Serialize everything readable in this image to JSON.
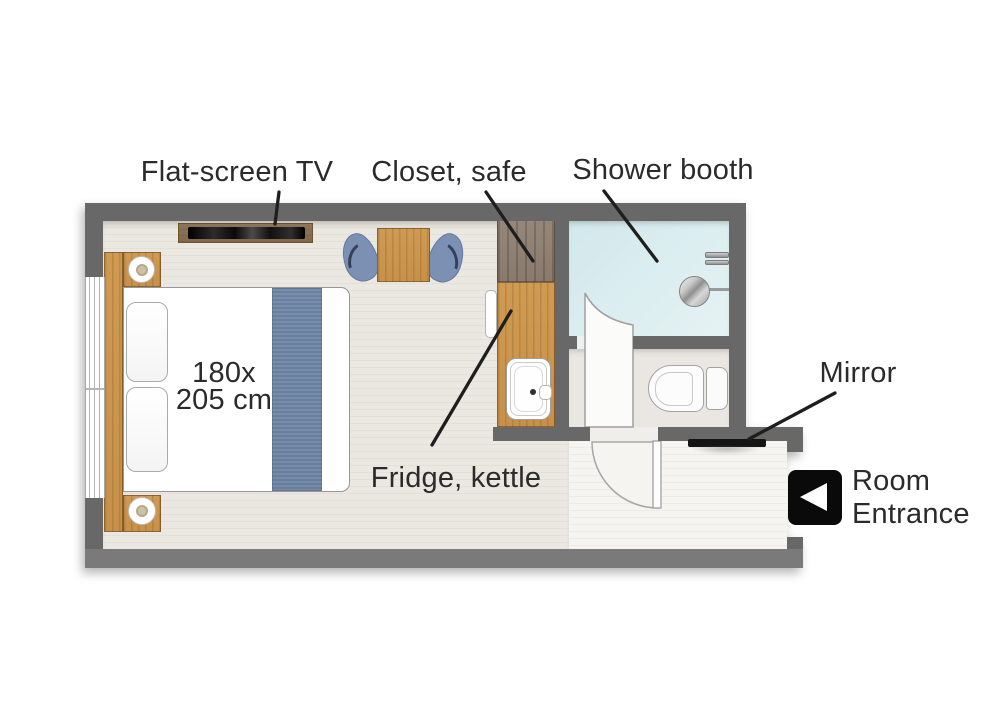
{
  "labels": {
    "flat_screen_tv": "Flat-screen TV",
    "closet_safe": "Closet, safe",
    "shower_booth": "Shower booth",
    "fridge_kettle": "Fridge, kettle",
    "mirror": "Mirror",
    "room_entrance": "Room\nEntrance",
    "bed_size": "180x\n205 cm"
  },
  "icons": {
    "room_entrance_arrow": "left-pointing-triangle-in-black-square"
  },
  "colors": {
    "wall": "#686868",
    "floor_main": "#ebe8e2",
    "floor_corridor": "#f5f4f1",
    "floor_bathroom": "#eae7e3",
    "floor_shower": "#dceef0",
    "wood_light": "#cf9a52",
    "wood_dark": "#8d7f71",
    "chair_blue": "#7b90b3",
    "blanket_blue": "#6f88a6",
    "label_text": "#2b2b2b",
    "entrance_icon_bg": "#0a0a0a",
    "mirror_black": "#141414"
  }
}
